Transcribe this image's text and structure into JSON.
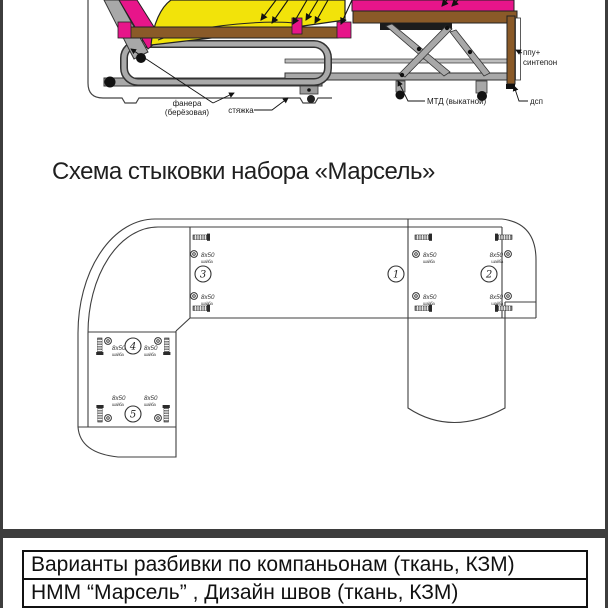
{
  "title": "Схема стыковки набора «Марсель»",
  "cross_section": {
    "labels": {
      "plywood": [
        "фанера",
        "(берёзовая)"
      ],
      "tie": "стяжка",
      "mtd": "МТД (выкатной)",
      "dsp": "дсп",
      "ppu": [
        "ппу+",
        "синтепон"
      ]
    },
    "colors": {
      "cushion_yellow": "#f2e30a",
      "upholstery_pink": "#e7158a",
      "wood_brown": "#8a5a28",
      "metal_gray": "#a8a8a8",
      "dark": "#1c1c1c"
    }
  },
  "assembly_plan": {
    "bolt_size": "8x50",
    "bolt_note": "шайба",
    "junctions": [
      "1",
      "2",
      "3",
      "4",
      "5"
    ]
  },
  "footer": {
    "row1": "Варианты разбивки по компаньонам (ткань, КЗМ)",
    "row2": "НММ “Марсель” , Дизайн швов (ткань, КЗМ)"
  }
}
